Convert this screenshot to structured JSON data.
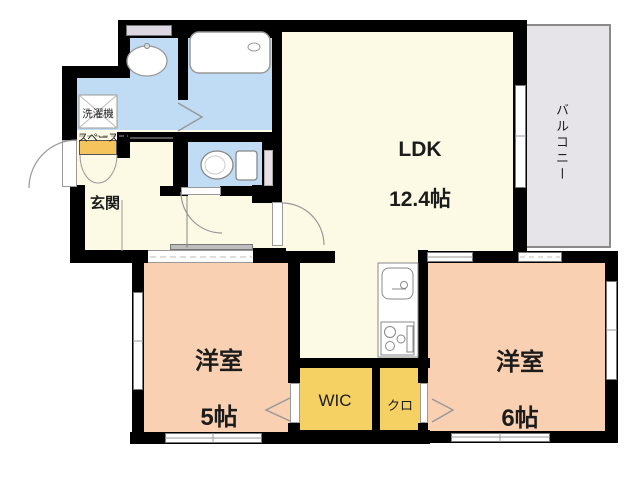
{
  "floorplan": {
    "title": "apartment-floor-plan",
    "rooms": {
      "ldk": {
        "name": "LDK",
        "size": "12.4帖"
      },
      "balcony": {
        "name": "バルコニー"
      },
      "laundry": {
        "line1": "洗濯機",
        "line2": "スペース"
      },
      "genkan": {
        "name": "玄関"
      },
      "room5": {
        "name": "洋室",
        "size": "5帖"
      },
      "room6": {
        "name": "洋室",
        "size": "6帖"
      },
      "wic": {
        "name": "WIC"
      },
      "closet": {
        "name": "クロ"
      }
    },
    "colors": {
      "wall": "#000000",
      "living_floor": "#FCFAE4",
      "bedroom_floor": "#F9D0B1",
      "wet_area_floor": "#BFDCF4",
      "closet_floor": "#F5D164",
      "shoe_cabinet": "#F6C45C",
      "balcony_floor": "#E6E4E8",
      "window_accent": "#DDD7E1"
    }
  }
}
